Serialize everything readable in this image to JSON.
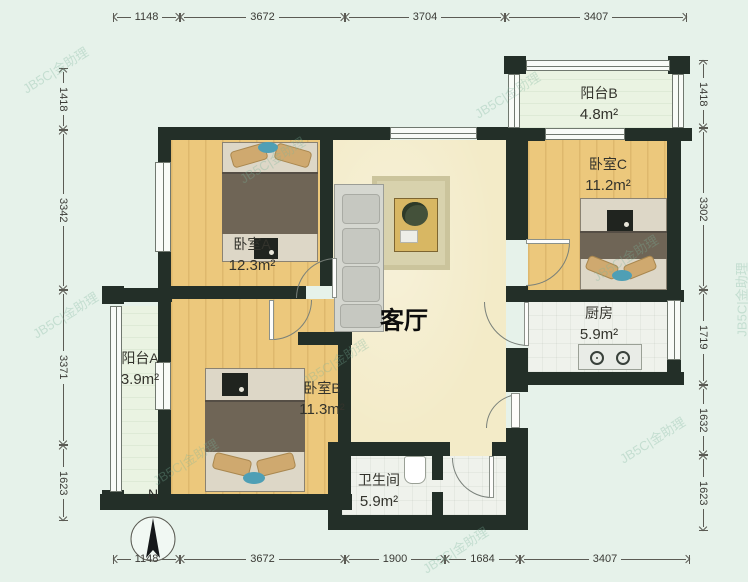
{
  "watermark": {
    "text": "JB5C|金助理"
  },
  "compass": {
    "label": "N"
  },
  "rooms": {
    "living_room": {
      "name": "客厅"
    },
    "bedroom_a": {
      "name": "卧室A",
      "area": "12.3m²"
    },
    "bedroom_b": {
      "name": "卧室B",
      "area": "11.3m²"
    },
    "bedroom_c": {
      "name": "卧室C",
      "area": "11.2m²"
    },
    "balcony_a": {
      "name": "阳台A",
      "area": "3.9m²"
    },
    "balcony_b": {
      "name": "阳台B",
      "area": "4.8m²"
    },
    "kitchen": {
      "name": "厨房",
      "area": "5.9m²"
    },
    "bathroom": {
      "name": "卫生间",
      "area": "5.9m²"
    }
  },
  "dimensions": {
    "top": [
      {
        "label": "1148",
        "pos": 113,
        "len": 67
      },
      {
        "label": "3672",
        "pos": 180,
        "len": 165
      },
      {
        "label": "3704",
        "pos": 345,
        "len": 160
      },
      {
        "label": "3407",
        "pos": 505,
        "len": 182
      }
    ],
    "bottom": [
      {
        "label": "1148",
        "pos": 113,
        "len": 67
      },
      {
        "label": "3672",
        "pos": 180,
        "len": 165
      },
      {
        "label": "1900",
        "pos": 345,
        "len": 100
      },
      {
        "label": "1684",
        "pos": 445,
        "len": 75
      },
      {
        "label": "3407",
        "pos": 520,
        "len": 170
      }
    ],
    "left": [
      {
        "label": "1418",
        "pos": 68,
        "len": 62
      },
      {
        "label": "3342",
        "pos": 130,
        "len": 160
      },
      {
        "label": "3371",
        "pos": 290,
        "len": 155
      },
      {
        "label": "1623",
        "pos": 445,
        "len": 76
      }
    ],
    "right": [
      {
        "label": "1418",
        "pos": 60,
        "len": 68
      },
      {
        "label": "3302",
        "pos": 128,
        "len": 162
      },
      {
        "label": "1719",
        "pos": 290,
        "len": 95
      },
      {
        "label": "1632",
        "pos": 385,
        "len": 70
      },
      {
        "label": "1623",
        "pos": 455,
        "len": 76
      }
    ]
  }
}
